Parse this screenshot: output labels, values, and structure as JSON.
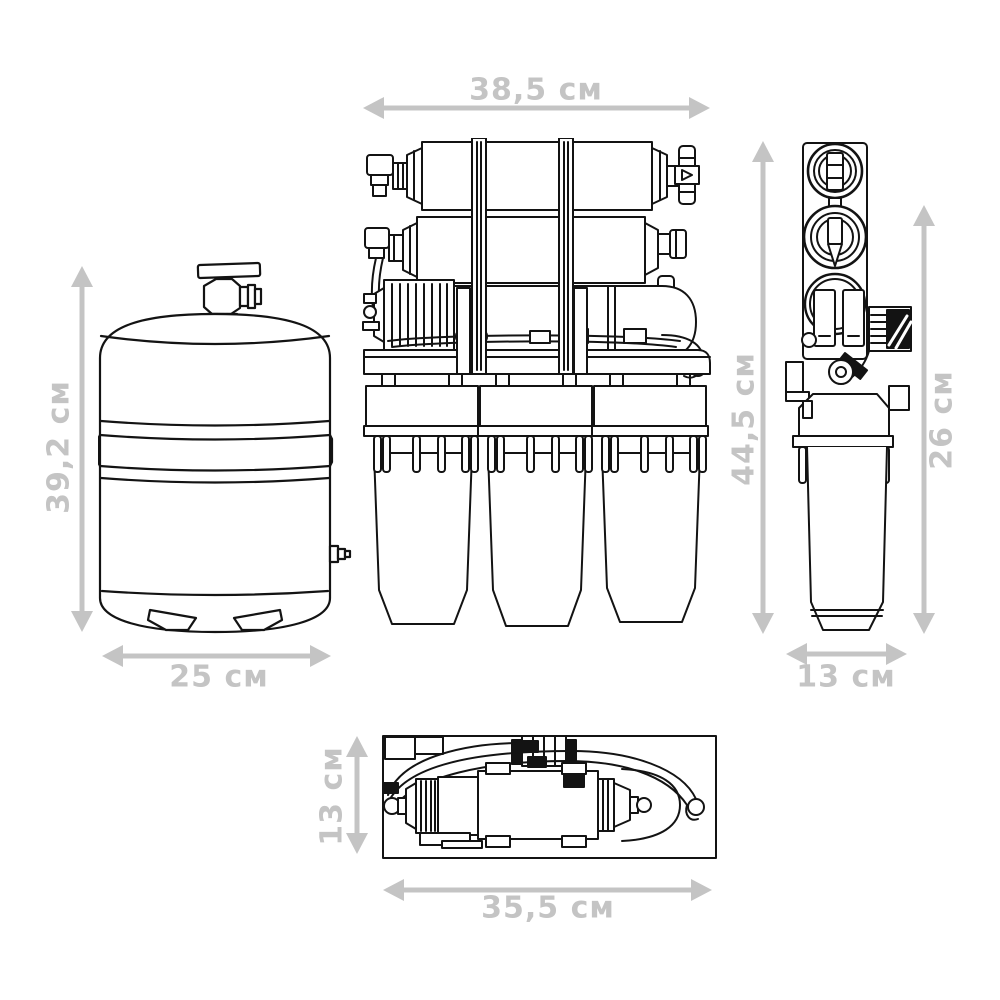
{
  "unit": "см",
  "colors": {
    "line": "#131313",
    "dimension": "#c4c4c4",
    "background": "#ffffff"
  },
  "views": {
    "tank": {
      "name": "storage-tank-view",
      "dims": {
        "height": {
          "label": "39,2 см"
        },
        "width": {
          "label": "25 см"
        }
      }
    },
    "front": {
      "name": "system-front-view",
      "dims": {
        "width": {
          "label": "38,5 см"
        },
        "height": {
          "label": "44,5 см"
        }
      }
    },
    "side": {
      "name": "system-side-view",
      "dims": {
        "height": {
          "label": "26 см"
        },
        "width": {
          "label": "13 см"
        }
      }
    },
    "top": {
      "name": "system-top-view",
      "dims": {
        "depth": {
          "label": "13 см"
        },
        "width": {
          "label": "35,5 см"
        }
      }
    }
  }
}
